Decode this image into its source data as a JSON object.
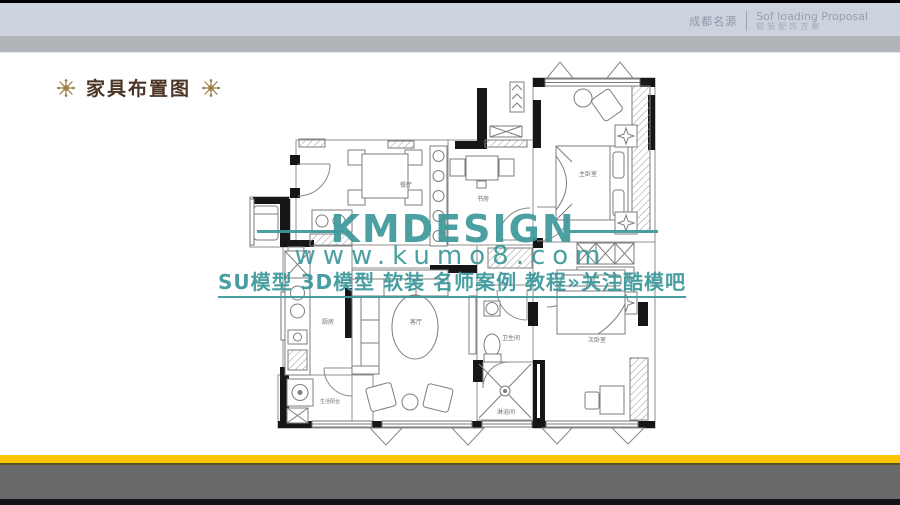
{
  "header": {
    "company": "成都名源",
    "proposal_en": "Sof loading Proposal",
    "proposal_cn": "软装配饰方案"
  },
  "slide": {
    "title": "家具布置图"
  },
  "watermark": {
    "brand": "KMDESIGN",
    "site": "www.kumo8.com",
    "tagline": "SU模型 3D模型 软装 名师案例 教程»关注酷模吧",
    "color": "#3f9b9d"
  },
  "floorplan": {
    "rooms": [
      {
        "name": "餐厅"
      },
      {
        "name": "书房"
      },
      {
        "name": "主卧室"
      },
      {
        "name": "厨房"
      },
      {
        "name": "客厅"
      },
      {
        "name": "卫生间"
      },
      {
        "name": "次卧室"
      },
      {
        "name": "淋浴间"
      },
      {
        "name": "生活阳台"
      }
    ]
  },
  "colors": {
    "accent_yellow": "#fcc605",
    "header_blue_gray": "#ccd3df",
    "footer_gray": "#68696b",
    "title_brown": "#4a3526",
    "ornament_gold": "#9b8048"
  }
}
